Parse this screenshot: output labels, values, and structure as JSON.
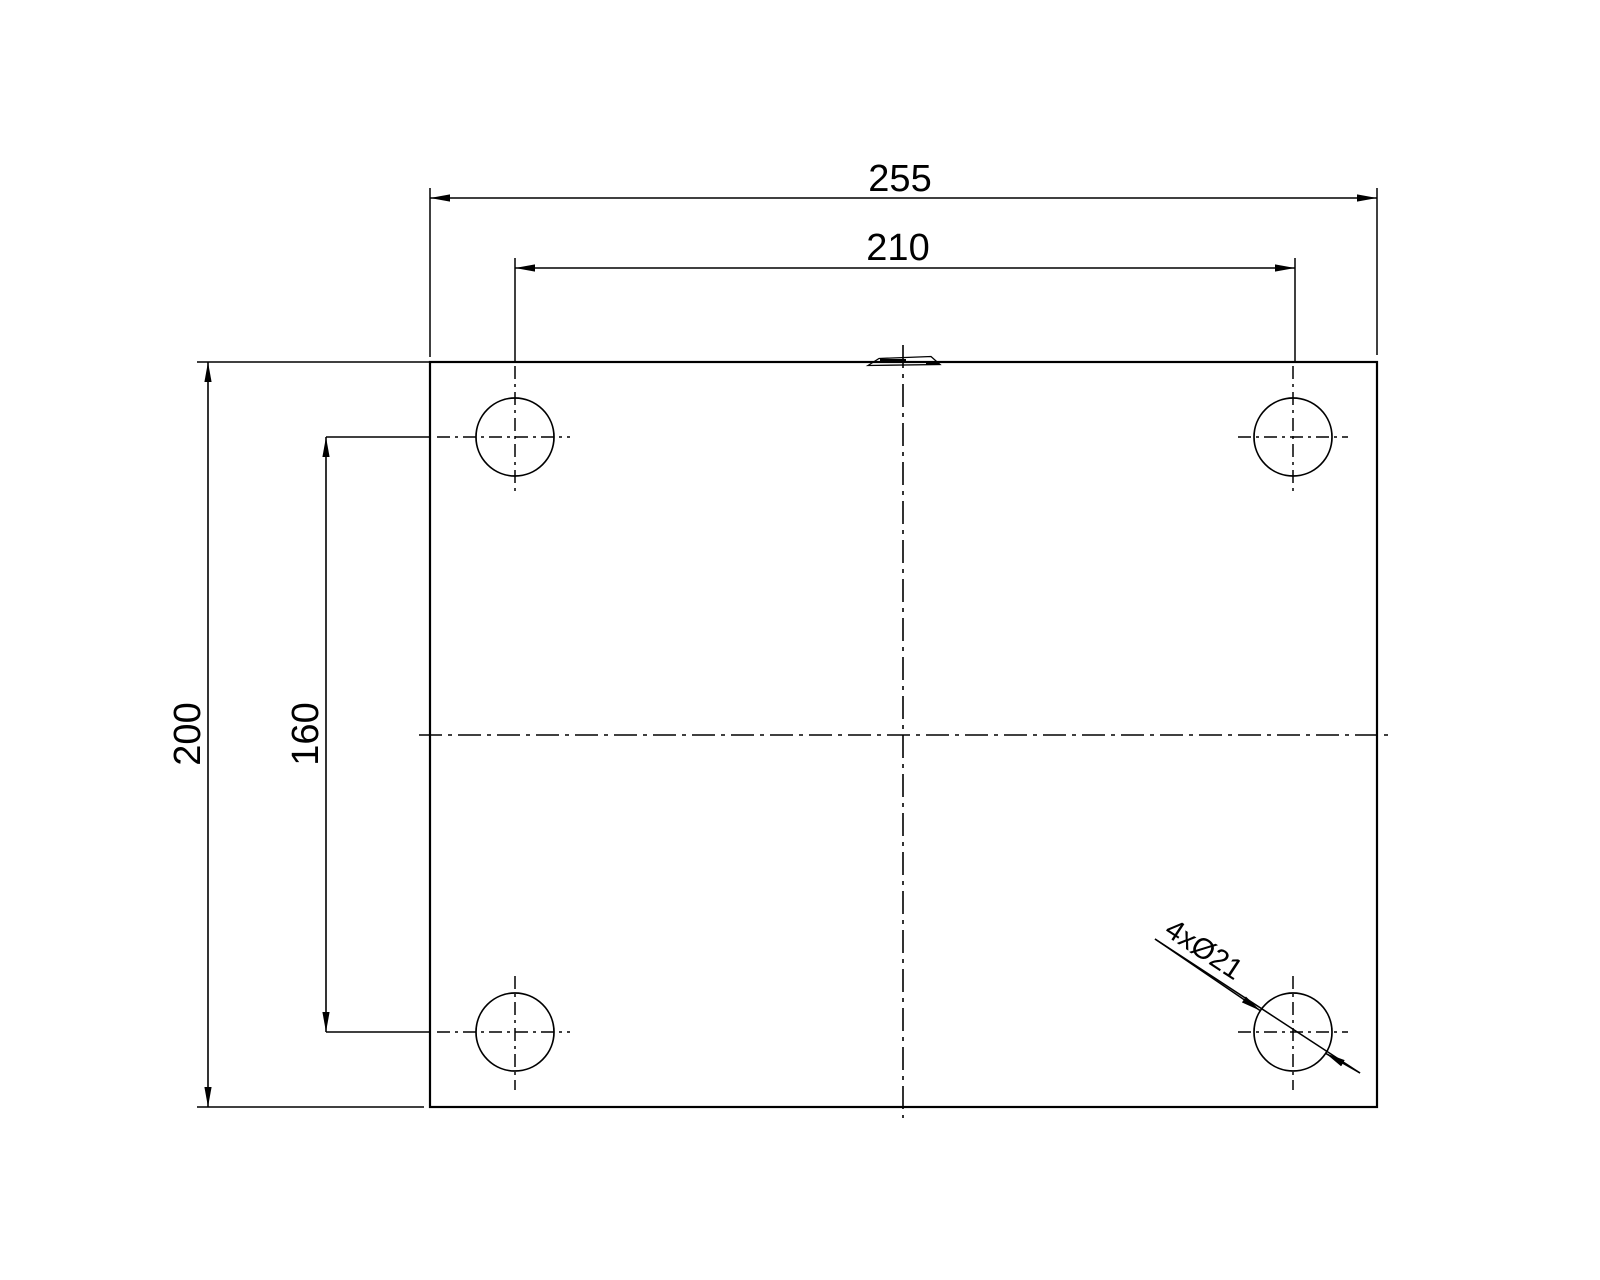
{
  "drawing": {
    "colors": {
      "background": "#ffffff",
      "line": "#000000"
    },
    "dimensions": {
      "overall_width": "255",
      "hole_pitch_horizontal": "210",
      "overall_height": "200",
      "hole_pitch_vertical": "160"
    },
    "labels": {
      "hole_callout": "4xØ21"
    }
  }
}
